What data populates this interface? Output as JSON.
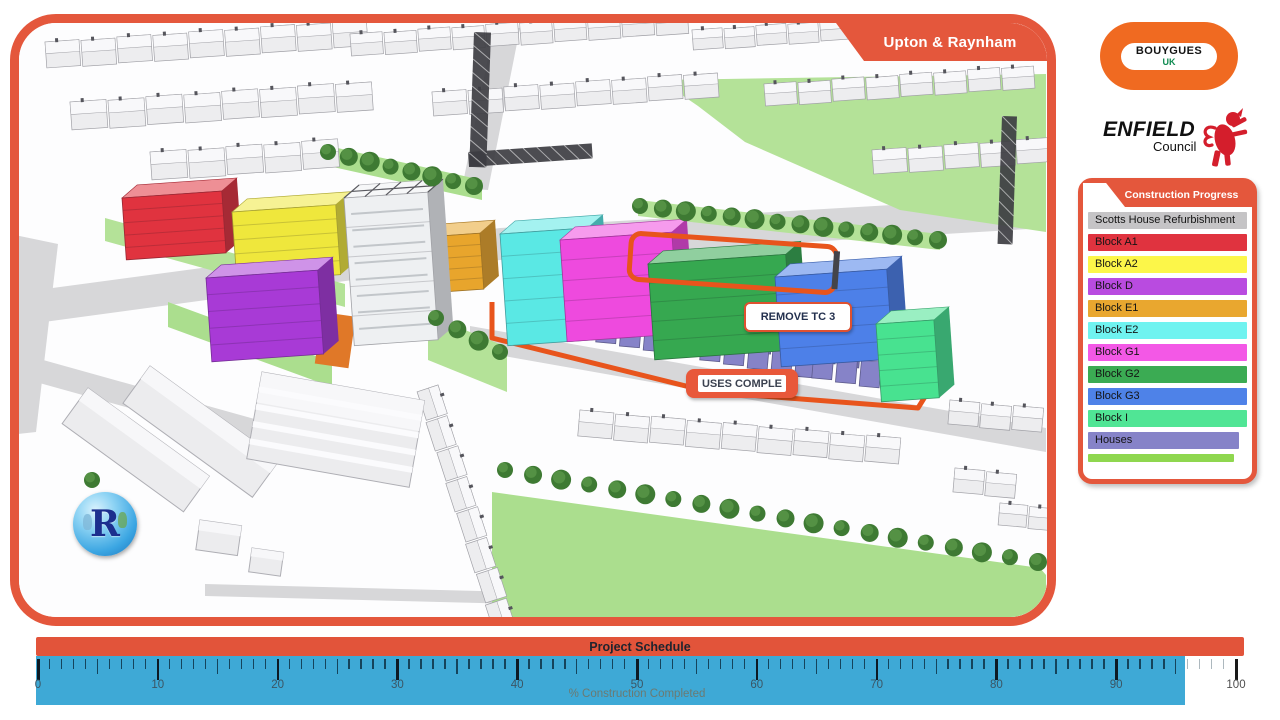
{
  "map_panel": {
    "title": "Upton & Raynham",
    "border_color": "#e4573c"
  },
  "logos": {
    "bouygues": {
      "line1": "BOUYGUES",
      "line2": "UK",
      "bg": "#f06a21"
    },
    "enfield": {
      "name": "ENFIELD",
      "sub": "Council",
      "crest_color": "#d41e2c"
    }
  },
  "legend": {
    "title": "Construction Progress",
    "items": [
      {
        "label": "Scotts House Refurbishment",
        "color": "#c5c4c6",
        "width_pct": 100
      },
      {
        "label": "Block A1",
        "color": "#e0333f",
        "width_pct": 100
      },
      {
        "label": "Block A2",
        "color": "#fcf649",
        "width_pct": 100
      },
      {
        "label": "Block D",
        "color": "#b94be0",
        "width_pct": 100
      },
      {
        "label": "Block E1",
        "color": "#e9a72f",
        "width_pct": 100
      },
      {
        "label": "Block E2",
        "color": "#6ff3f0",
        "width_pct": 100
      },
      {
        "label": "Block G1",
        "color": "#f358e6",
        "width_pct": 100
      },
      {
        "label": "Block G2",
        "color": "#3bab53",
        "width_pct": 100
      },
      {
        "label": "Block G3",
        "color": "#4e82e8",
        "width_pct": 100
      },
      {
        "label": "Block I",
        "color": "#50e595",
        "width_pct": 100
      },
      {
        "label": "Houses",
        "color": "#8683c8",
        "width_pct": 95
      },
      {
        "label": "",
        "color": "#8fd74f",
        "width_pct": 92,
        "thin": true
      }
    ]
  },
  "schedule": {
    "title": "Project Schedule",
    "axis_label": "% Construction Completed",
    "tick_min": 0,
    "tick_max": 100,
    "tick_labels": [
      "0",
      "10",
      "20",
      "30",
      "40",
      "50",
      "60",
      "70",
      "80",
      "90",
      "100"
    ],
    "completed_percent": 96,
    "bar_color": "#e2543a",
    "ruler_color": "#3ea9d6"
  },
  "callouts": [
    {
      "text": "REMOVE TC 3"
    },
    {
      "text": "USES COMPLE"
    }
  ],
  "school_badge": {
    "letter": "R"
  },
  "scene": {
    "ground": "#fdfdfe",
    "road_color": "#d7d7d9",
    "grass": "#abde8e",
    "grass2": "#b4e298",
    "tree_dark": "#3e7a33",
    "tree_light": "#549144",
    "ctx_fill": "#ededef",
    "ctx_roof": "#f8f8fa",
    "ctx_line": "#a0a0a6",
    "boundary_color": "#e8541c",
    "crane_color": "#3d3d42",
    "courtyard_color": "#e07828",
    "houses_color": "#8683c8",
    "roads": [
      [
        [
          0,
          295
        ],
        [
          500,
          228
        ],
        [
          1046,
          196
        ],
        [
          1046,
          228
        ],
        [
          500,
          260
        ],
        [
          0,
          328
        ]
      ],
      [
        [
          494,
          28
        ],
        [
          520,
          28
        ],
        [
          488,
          190
        ],
        [
          462,
          188
        ]
      ],
      [
        [
          0,
          348
        ],
        [
          330,
          440
        ],
        [
          330,
          464
        ],
        [
          0,
          372
        ]
      ],
      [
        [
          470,
          326
        ],
        [
          1046,
          428
        ],
        [
          1046,
          452
        ],
        [
          470,
          350
        ]
      ],
      [
        [
          0,
          232
        ],
        [
          58,
          244
        ],
        [
          36,
          432
        ],
        [
          0,
          436
        ]
      ],
      [
        [
          205,
          584
        ],
        [
          520,
          592
        ],
        [
          520,
          604
        ],
        [
          205,
          596
        ]
      ]
    ],
    "greens": [
      [
        [
          660,
          80
        ],
        [
          1046,
          74
        ],
        [
          1046,
          232
        ],
        [
          900,
          210
        ],
        [
          745,
          142
        ],
        [
          698,
          106
        ]
      ],
      [
        [
          492,
          492
        ],
        [
          1040,
          568
        ],
        [
          1046,
          575
        ],
        [
          1046,
          617
        ],
        [
          492,
          617
        ]
      ],
      [
        [
          105,
          218
        ],
        [
          345,
          284
        ],
        [
          345,
          307
        ],
        [
          105,
          241
        ]
      ],
      [
        [
          168,
          302
        ],
        [
          332,
          362
        ],
        [
          332,
          387
        ],
        [
          168,
          327
        ]
      ],
      [
        [
          428,
          315
        ],
        [
          507,
          347
        ],
        [
          507,
          392
        ],
        [
          428,
          360
        ]
      ],
      [
        [
          315,
          143
        ],
        [
          482,
          180
        ],
        [
          482,
          200
        ],
        [
          315,
          163
        ]
      ],
      [
        [
          638,
          200
        ],
        [
          940,
          234
        ],
        [
          940,
          250
        ],
        [
          638,
          216
        ]
      ]
    ],
    "context_rows": [
      {
        "x": 45,
        "y": 42,
        "n": 9,
        "w": 34,
        "h": 26,
        "a": -4
      },
      {
        "x": 350,
        "y": 34,
        "n": 10,
        "w": 32,
        "h": 22,
        "a": -4
      },
      {
        "x": 692,
        "y": 30,
        "n": 11,
        "w": 30,
        "h": 20,
        "a": -4
      },
      {
        "x": 70,
        "y": 102,
        "n": 8,
        "w": 36,
        "h": 28,
        "a": -4
      },
      {
        "x": 432,
        "y": 92,
        "n": 8,
        "w": 34,
        "h": 24,
        "a": -4
      },
      {
        "x": 764,
        "y": 84,
        "n": 8,
        "w": 32,
        "h": 22,
        "a": -4
      },
      {
        "x": 150,
        "y": 152,
        "n": 5,
        "w": 36,
        "h": 28,
        "a": -4
      },
      {
        "x": 872,
        "y": 150,
        "n": 5,
        "w": 34,
        "h": 24,
        "a": -4
      },
      {
        "x": 580,
        "y": 410,
        "n": 9,
        "w": 34,
        "h": 26,
        "a": 5
      },
      {
        "x": 950,
        "y": 400,
        "n": 3,
        "w": 30,
        "h": 24,
        "a": 5
      },
      {
        "x": 438,
        "y": 385,
        "n": 8,
        "w": 30,
        "h": 22,
        "a": 72
      },
      {
        "x": 955,
        "y": 468,
        "n": 2,
        "w": 30,
        "h": 24,
        "a": 5
      },
      {
        "x": 1000,
        "y": 503,
        "n": 2,
        "w": 28,
        "h": 22,
        "a": 5
      }
    ],
    "big_buildings": [
      {
        "x": 88,
        "y": 388,
        "w": 150,
        "h": 44,
        "a": 36,
        "stripes": false
      },
      {
        "x": 150,
        "y": 366,
        "w": 160,
        "h": 46,
        "a": 36,
        "stripes": false
      },
      {
        "x": 262,
        "y": 372,
        "w": 165,
        "h": 88,
        "a": 10,
        "stripes": true
      },
      {
        "x": 200,
        "y": 520,
        "w": 42,
        "h": 30,
        "a": 8,
        "stripes": false
      },
      {
        "x": 252,
        "y": 548,
        "w": 32,
        "h": 24,
        "a": 8,
        "stripes": false
      }
    ],
    "blocks": [
      {
        "name": "block-a1",
        "color": "#e0333f",
        "x": 122,
        "y": 198,
        "w": 100,
        "h": 62
      },
      {
        "name": "block-a2",
        "color": "#efe73c",
        "x": 232,
        "y": 212,
        "w": 104,
        "h": 70
      },
      {
        "name": "block-d",
        "color": "#a83ad6",
        "x": 206,
        "y": 278,
        "w": 112,
        "h": 84
      },
      {
        "name": "block-e1",
        "color": "#e8a52c",
        "x": 426,
        "y": 237,
        "w": 54,
        "h": 56
      },
      {
        "name": "scotts-house-tower",
        "color": "#eef0f2",
        "x": 344,
        "y": 198,
        "w": 84,
        "h": 148,
        "scaffold": true
      },
      {
        "name": "block-e2",
        "color": "#5ae8e4",
        "x": 500,
        "y": 234,
        "w": 88,
        "h": 112
      },
      {
        "name": "block-g1",
        "color": "#ee4ade",
        "x": 560,
        "y": 240,
        "w": 112,
        "h": 102
      },
      {
        "name": "block-g2",
        "color": "#36a850",
        "x": 648,
        "y": 264,
        "w": 138,
        "h": 96
      },
      {
        "name": "block-g3",
        "color": "#4d80e8",
        "x": 775,
        "y": 277,
        "w": 112,
        "h": 90
      },
      {
        "name": "block-i",
        "color": "#48e290",
        "x": 876,
        "y": 324,
        "w": 58,
        "h": 78
      }
    ],
    "house_clusters": [
      {
        "x": 598,
        "y": 316,
        "n": 4
      },
      {
        "x": 702,
        "y": 334,
        "n": 5
      },
      {
        "x": 814,
        "y": 352,
        "n": 4
      }
    ],
    "tree_lines": [
      {
        "x1": 328,
        "y1": 152,
        "x2": 474,
        "y2": 186,
        "n": 8
      },
      {
        "x1": 640,
        "y1": 206,
        "x2": 938,
        "y2": 240,
        "n": 14
      },
      {
        "x1": 505,
        "y1": 470,
        "x2": 1038,
        "y2": 562,
        "n": 20
      },
      {
        "x1": 92,
        "y1": 480,
        "x2": 120,
        "y2": 508,
        "n": 2
      },
      {
        "x1": 436,
        "y1": 318,
        "x2": 500,
        "y2": 352,
        "n": 4
      }
    ],
    "boundary_path": "M492,302 L492,338 L710,392 L918,408 L944,366 L944,316",
    "highlight": {
      "x": 630,
      "y": 240,
      "w": 206,
      "h": 46,
      "a": 4
    },
    "courtyard": {
      "x": 322,
      "y": 312,
      "w": 34,
      "h": 52,
      "a": 8
    },
    "cranes": [
      {
        "x": 468,
        "y": 152,
        "w": 124,
        "h": 15,
        "a": -4
      },
      {
        "x": 474,
        "y": 32,
        "w": 17,
        "h": 135,
        "a": 2
      },
      {
        "x": 1002,
        "y": 116,
        "w": 15,
        "h": 128,
        "a": 2
      }
    ]
  }
}
